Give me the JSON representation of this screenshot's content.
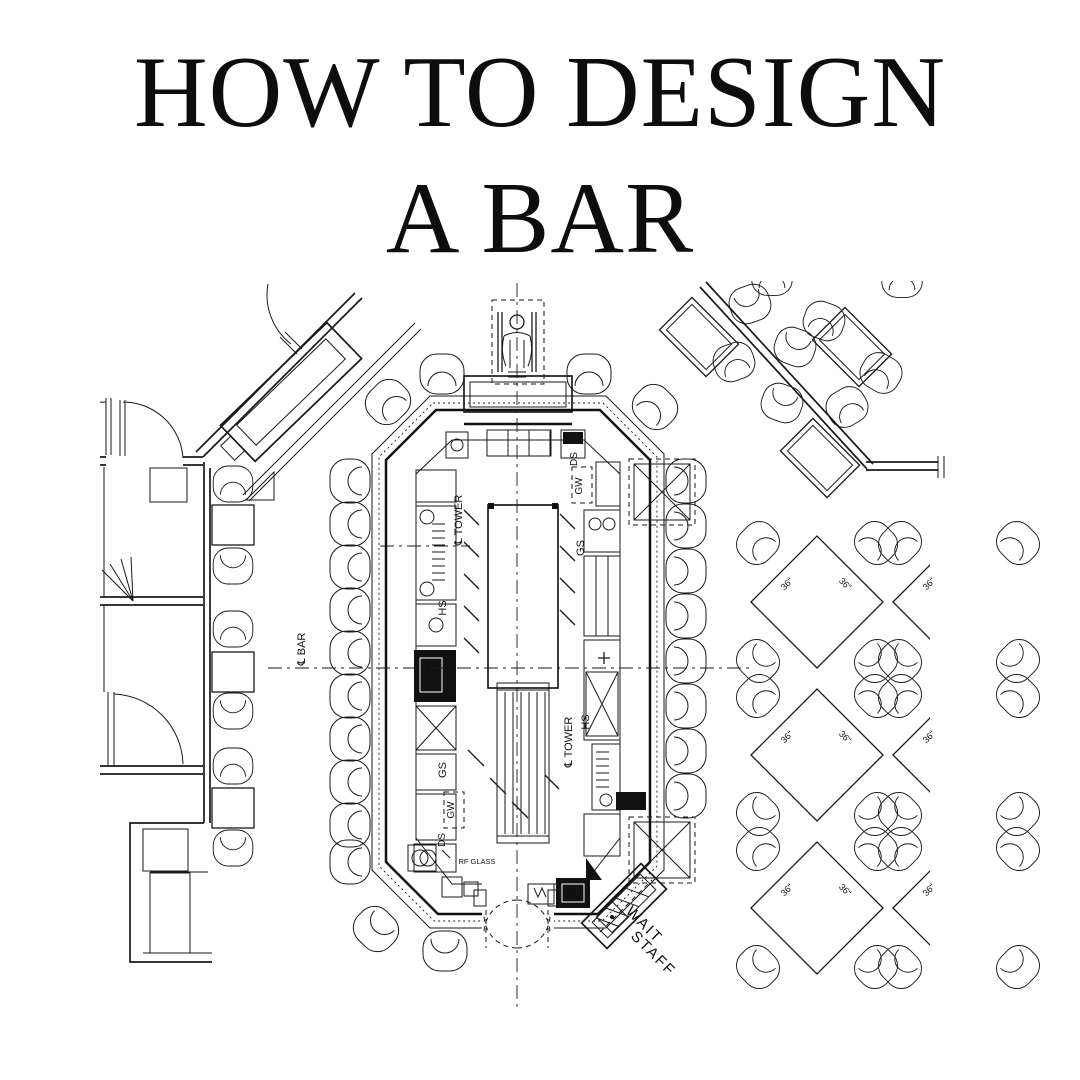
{
  "page": {
    "bg": "#ffffff",
    "ink": "#151515"
  },
  "title": {
    "line1": "HOW TO DESIGN",
    "line2": "A BAR"
  },
  "plan": {
    "diamond_label": "36\"",
    "annotations": [
      {
        "text": "℄ TOWER",
        "x": 462,
        "y": 520,
        "rot": -90,
        "size": 11
      },
      {
        "text": "℄ TOWER",
        "x": 572,
        "y": 742,
        "rot": -90,
        "size": 11
      },
      {
        "text": "HS",
        "x": 446,
        "y": 608,
        "rot": -90,
        "size": 11
      },
      {
        "text": "HS",
        "x": 589,
        "y": 722,
        "rot": -90,
        "size": 11
      },
      {
        "text": "GS",
        "x": 446,
        "y": 770,
        "rot": -90,
        "size": 11
      },
      {
        "text": "GS",
        "x": 584,
        "y": 548,
        "rot": -90,
        "size": 11
      },
      {
        "text": "GW",
        "x": 454,
        "y": 810,
        "rot": -90,
        "size": 10
      },
      {
        "text": "GW",
        "x": 582,
        "y": 486,
        "rot": -90,
        "size": 10
      },
      {
        "text": "DS",
        "x": 445,
        "y": 840,
        "rot": -90,
        "size": 10
      },
      {
        "text": "DS",
        "x": 577,
        "y": 459,
        "rot": -90,
        "size": 10
      },
      {
        "text": "℄ BAR",
        "x": 305,
        "y": 649,
        "rot": -90,
        "size": 11
      },
      {
        "text": "RF GLASS",
        "x": 477,
        "y": 864,
        "rot": 0,
        "size": 7.5
      },
      {
        "text": "POS",
        "x": 573,
        "y": 897,
        "rot": 0,
        "size": 8,
        "color": "#ffffff"
      },
      {
        "text": "WAIT",
        "x": 641,
        "y": 928,
        "rot": 45,
        "size": 15,
        "spacing": 2
      },
      {
        "text": "STAFF",
        "x": 650,
        "y": 957,
        "rot": 45,
        "size": 15,
        "spacing": 2
      }
    ],
    "furniture": {
      "bar_stools": [
        {
          "x": 350,
          "y": 481,
          "r": -90
        },
        {
          "x": 350,
          "y": 524,
          "r": -90
        },
        {
          "x": 350,
          "y": 567,
          "r": -90
        },
        {
          "x": 350,
          "y": 610,
          "r": -90
        },
        {
          "x": 350,
          "y": 653,
          "r": -90
        },
        {
          "x": 350,
          "y": 696,
          "r": -90
        },
        {
          "x": 350,
          "y": 739,
          "r": -90
        },
        {
          "x": 350,
          "y": 782,
          "r": -90
        },
        {
          "x": 350,
          "y": 825,
          "r": -90
        },
        {
          "x": 350,
          "y": 862,
          "r": -90
        },
        {
          "x": 686,
          "y": 481,
          "r": 90
        },
        {
          "x": 686,
          "y": 526,
          "r": 90
        },
        {
          "x": 686,
          "y": 571,
          "r": 90
        },
        {
          "x": 686,
          "y": 616,
          "r": 90
        },
        {
          "x": 686,
          "y": 661,
          "r": 90
        },
        {
          "x": 686,
          "y": 706,
          "r": 90
        },
        {
          "x": 686,
          "y": 751,
          "r": 90
        },
        {
          "x": 686,
          "y": 796,
          "r": 90
        },
        {
          "x": 442,
          "y": 374,
          "r": 0
        },
        {
          "x": 589,
          "y": 374,
          "r": 0
        },
        {
          "x": 388,
          "y": 402,
          "r": -45
        },
        {
          "x": 655,
          "y": 407,
          "r": 45
        },
        {
          "x": 376,
          "y": 929,
          "r": -135
        },
        {
          "x": 445,
          "y": 951,
          "r": 180
        }
      ],
      "dining_chairs": [
        {
          "x": 233,
          "y": 484,
          "r": 0
        },
        {
          "x": 233,
          "y": 566,
          "r": 180
        },
        {
          "x": 233,
          "y": 629,
          "r": 0
        },
        {
          "x": 233,
          "y": 711,
          "r": 180
        },
        {
          "x": 233,
          "y": 766,
          "r": 0
        },
        {
          "x": 233,
          "y": 848,
          "r": 180
        }
      ],
      "dining_tables": [
        {
          "x": 212,
          "y": 505
        },
        {
          "x": 212,
          "y": 652
        },
        {
          "x": 212,
          "y": 788
        }
      ],
      "diag_tables": [
        {
          "x": 699,
          "y": 337
        },
        {
          "x": 852,
          "y": 347
        },
        {
          "x": 820,
          "y": 458
        }
      ],
      "diag_chairs": [
        {
          "x": 750,
          "y": 304,
          "r": 160
        },
        {
          "x": 824,
          "y": 321,
          "r": 20
        },
        {
          "x": 795,
          "y": 347,
          "r": -160
        },
        {
          "x": 734,
          "y": 362,
          "r": -20
        },
        {
          "x": 881,
          "y": 373,
          "r": 30
        },
        {
          "x": 782,
          "y": 403,
          "r": 200
        },
        {
          "x": 847,
          "y": 407,
          "r": -30
        },
        {
          "x": 772,
          "y": 277,
          "r": 0
        },
        {
          "x": 902,
          "y": 279,
          "r": 0
        }
      ],
      "diamond_tables": {
        "cx": [
          817,
          959
        ],
        "cy": [
          602,
          755,
          908
        ],
        "half": 66,
        "chair_dx": 59,
        "chair_dy": 59
      }
    }
  }
}
